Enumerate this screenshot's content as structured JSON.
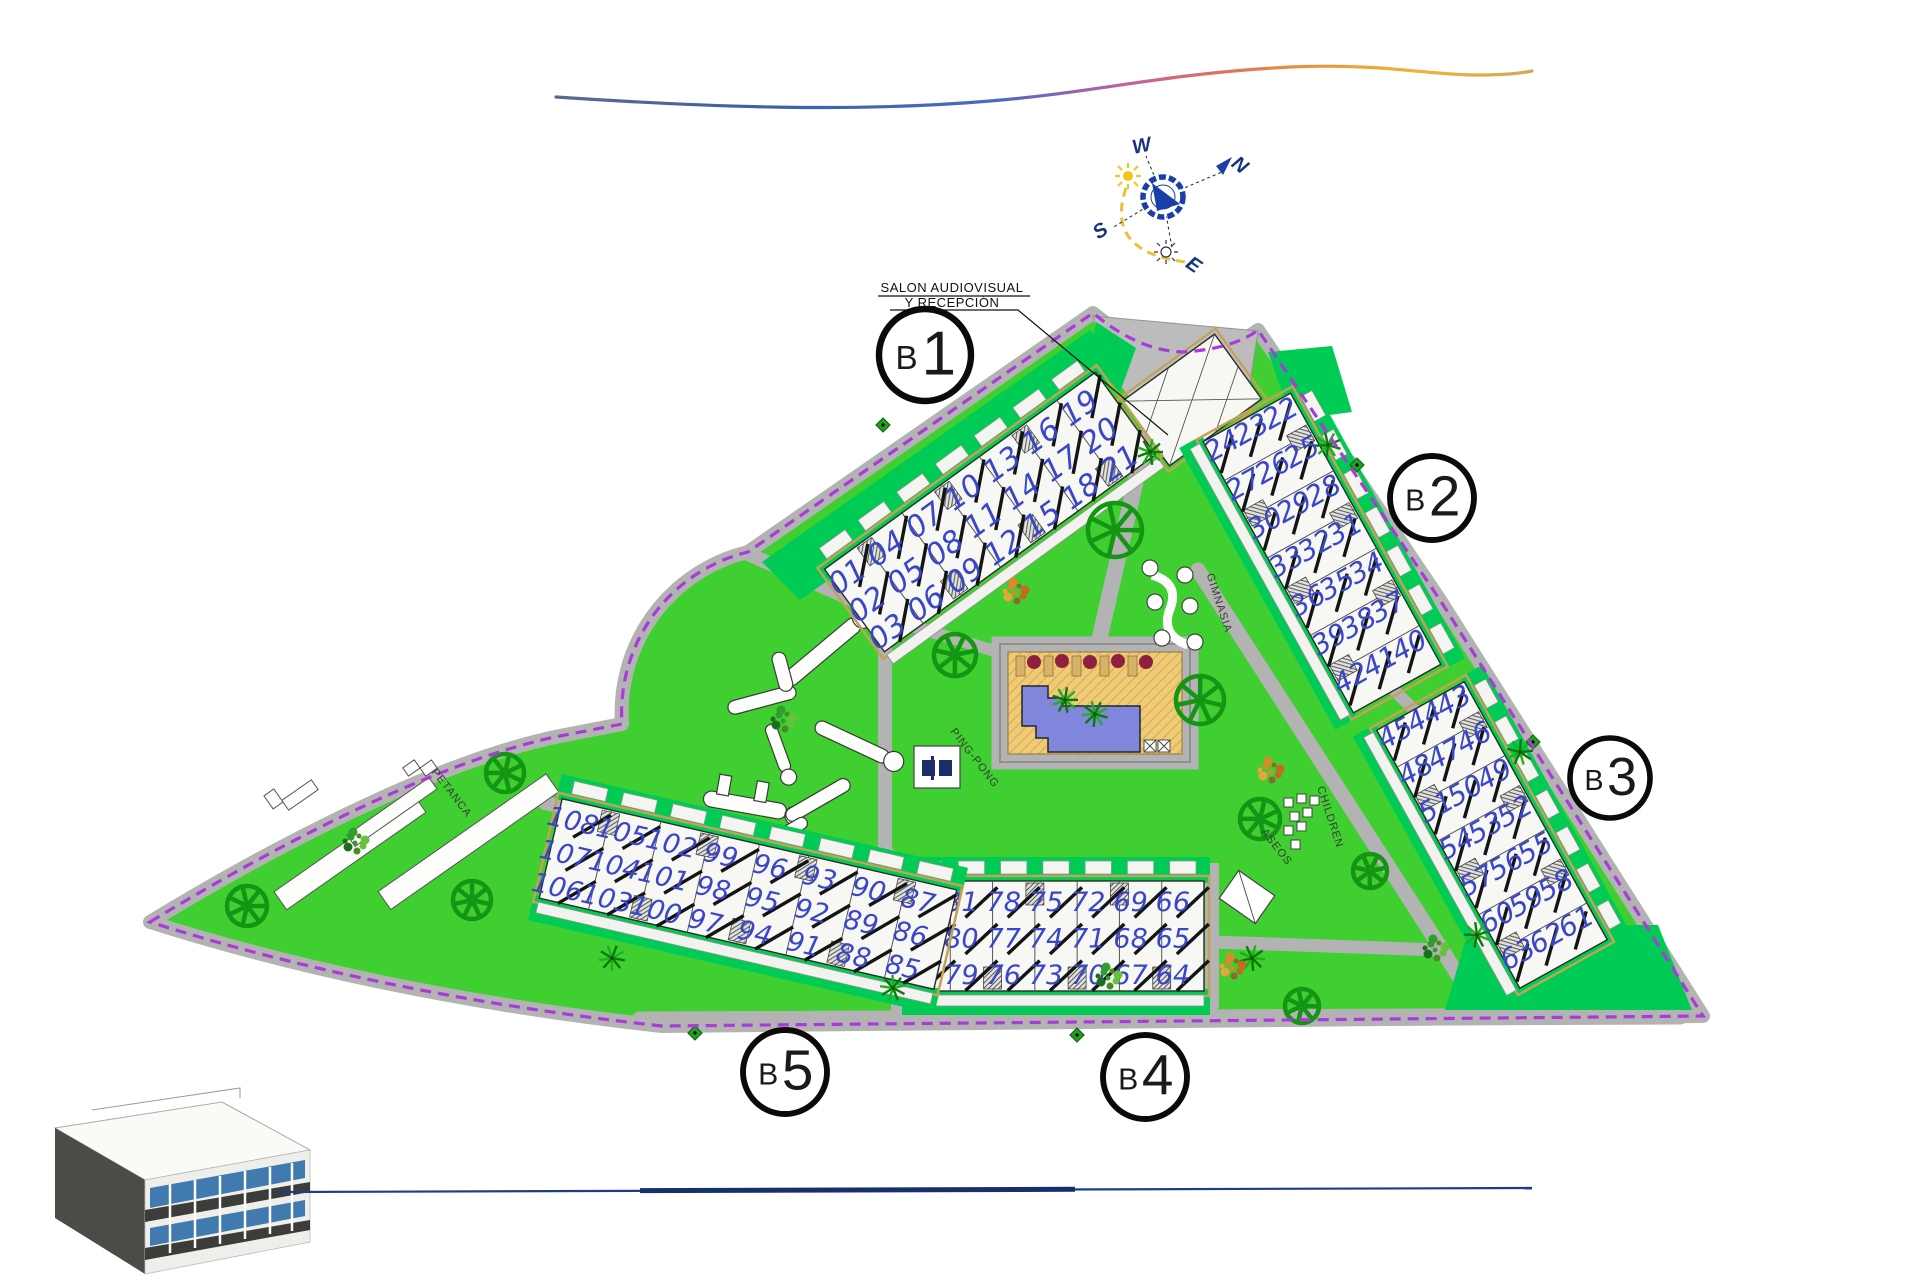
{
  "page": {
    "background": "#ffffff"
  },
  "compass": {
    "n": "N",
    "s": "S",
    "e": "E",
    "w": "W"
  },
  "labels": {
    "reception1": "SALON AUDIOVISUAL",
    "reception2": "Y RECEPCIÓN",
    "petanca": "PETANCA",
    "pingpong": "PING-PONG",
    "gimnasia": "GIMNASIA",
    "children": "CHILDREN",
    "aseos": "ASEOS"
  },
  "blocks": [
    {
      "letter": "B",
      "number": "1"
    },
    {
      "letter": "B",
      "number": "2"
    },
    {
      "letter": "B",
      "number": "3"
    },
    {
      "letter": "B",
      "number": "4"
    },
    {
      "letter": "B",
      "number": "5"
    }
  ],
  "buildings": {
    "B1": {
      "columns": [
        [
          "01",
          "02",
          "03"
        ],
        [
          "04",
          "05",
          "06"
        ],
        [
          "07",
          "08",
          "09"
        ],
        [
          "10",
          "11",
          "12"
        ],
        [
          "13",
          "14",
          "15"
        ],
        [
          "16",
          "17",
          "18"
        ],
        [
          "19",
          "20",
          "21"
        ]
      ]
    },
    "B2": {
      "columns": [
        [
          "22",
          "23",
          "24"
        ],
        [
          "25",
          "26",
          "27"
        ],
        [
          "28",
          "29",
          "30"
        ],
        [
          "31",
          "32",
          "33"
        ],
        [
          "34",
          "35",
          "36"
        ],
        [
          "37",
          "38",
          "39"
        ],
        [
          "40",
          "41",
          "42"
        ]
      ]
    },
    "B3": {
      "columns": [
        [
          "43",
          "44",
          "45"
        ],
        [
          "46",
          "47",
          "48"
        ],
        [
          "49",
          "50",
          "51"
        ],
        [
          "52",
          "53",
          "54"
        ],
        [
          "55",
          "56",
          "57"
        ],
        [
          "58",
          "59",
          "60"
        ],
        [
          "61",
          "62",
          "63"
        ]
      ]
    },
    "B4": {
      "columns": [
        [
          "84",
          "83",
          "82"
        ],
        [
          "81",
          "80",
          "79"
        ],
        [
          "78",
          "77",
          "76"
        ],
        [
          "75",
          "74",
          "73"
        ],
        [
          "72",
          "71",
          "70"
        ],
        [
          "69",
          "68",
          "67"
        ],
        [
          "66",
          "65",
          "64"
        ]
      ]
    },
    "B5": {
      "columns": [
        [
          "108",
          "107",
          "106"
        ],
        [
          "105",
          "104",
          "103"
        ],
        [
          "102",
          "101",
          "100"
        ],
        [
          "99",
          "98",
          "97"
        ],
        [
          "96",
          "95",
          "94"
        ],
        [
          "93",
          "92",
          "91"
        ],
        [
          "90",
          "89",
          "88"
        ],
        [
          "87",
          "86",
          "85"
        ]
      ]
    }
  },
  "colors": {
    "lawn": "#3fcf30",
    "garden": "#00cc55",
    "road": "#b3b3b3",
    "boundary": "#a93bd8",
    "building": "#f7f7f3",
    "building_edge": "#c2a257",
    "unit_number": "#3a46c8",
    "pool_water": "#8086dc",
    "pool_deck": "#eecb74",
    "umbrella": "#8e2040",
    "tree": "#149614",
    "compass_blue": "#1a3fa8",
    "sun": "#f2c518",
    "bottom_line": "#1c3c8c"
  }
}
